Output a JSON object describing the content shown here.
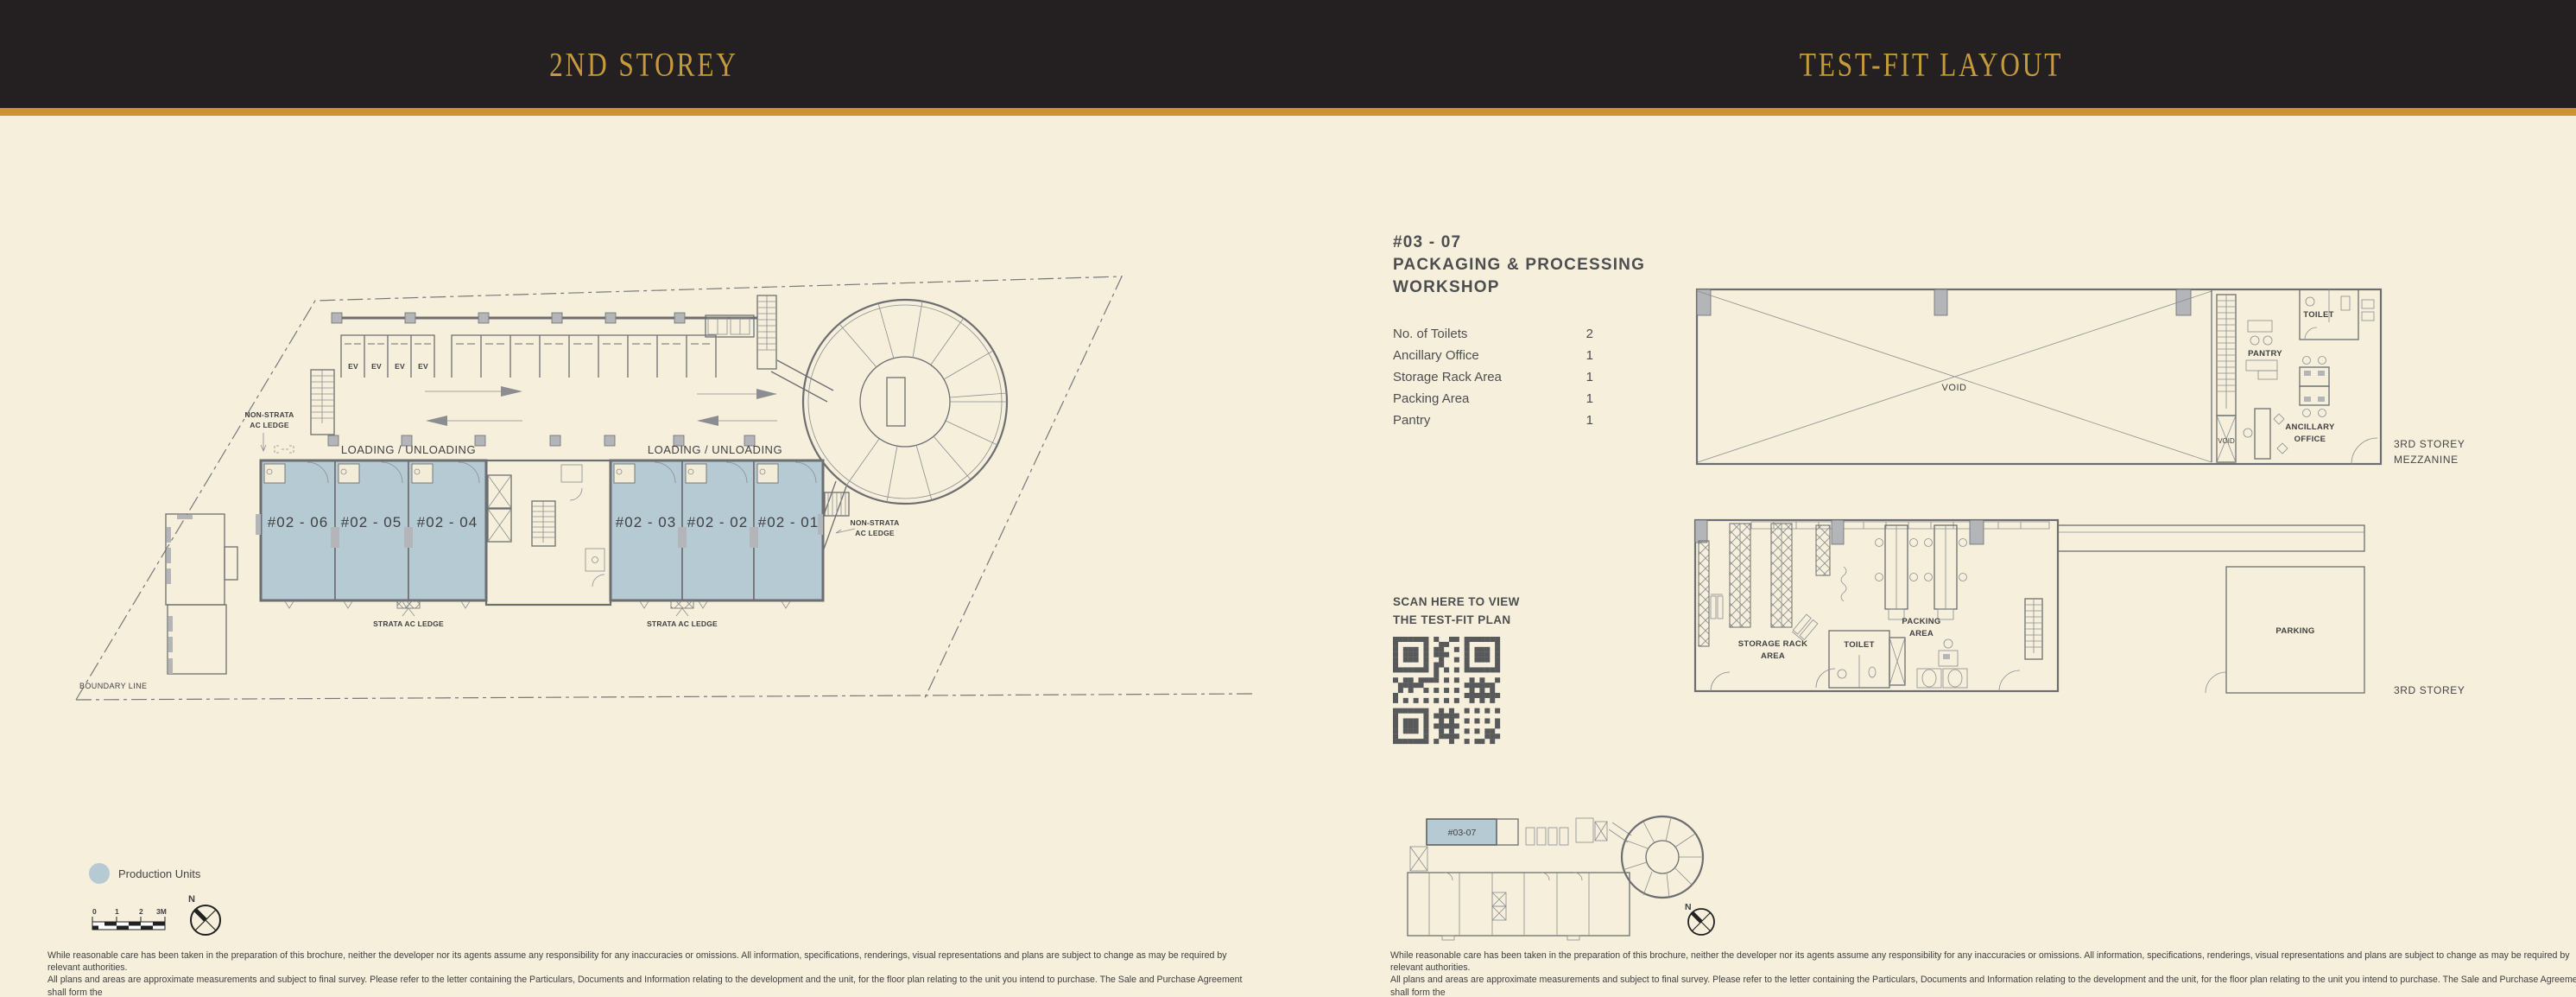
{
  "header": {
    "left_title": "2ND STOREY",
    "right_title": "TEST-FIT LAYOUT"
  },
  "left_plan": {
    "units": [
      "#02 - 06",
      "#02 - 05",
      "#02 - 04",
      "#02 - 03",
      "#02 - 02",
      "#02 - 01"
    ],
    "labels": {
      "loading_left": "LOADING / UNLOADING",
      "loading_right": "LOADING / UNLOADING",
      "strata_left": "STRATA AC LEDGE",
      "strata_right": "STRATA AC LEDGE",
      "non_strata_left_1": "NON-STRATA",
      "non_strata_left_2": "AC LEDGE",
      "non_strata_right_1": "NON-STRATA",
      "non_strata_right_2": "AC LEDGE",
      "boundary": "BOUNDARY LINE",
      "ev": "EV"
    },
    "legend": {
      "label": "Production Units",
      "swatch_color": "#b5cad3"
    },
    "scale_ticks": [
      "0",
      "1",
      "2",
      "3M"
    ],
    "compass_n": "N"
  },
  "right_panel": {
    "unit_no": "#03 - 07",
    "unit_title_1": "PACKAGING & PROCESSING",
    "unit_title_2": "WORKSHOP",
    "facilities": [
      {
        "label": "No. of Toilets",
        "value": "2"
      },
      {
        "label": "Ancillary Office",
        "value": "1"
      },
      {
        "label": "Storage Rack Area",
        "value": "1"
      },
      {
        "label": "Packing Area",
        "value": "1"
      },
      {
        "label": "Pantry",
        "value": "1"
      }
    ],
    "qr_caption_1": "SCAN HERE TO VIEW",
    "qr_caption_2": "THE TEST-FIT PLAN",
    "mezzanine": {
      "void_big": "VOID",
      "void_small": "VOID",
      "pantry": "PANTRY",
      "toilet": "TOILET",
      "ancillary_1": "ANCILLARY",
      "ancillary_2": "OFFICE",
      "side_1": "3RD STOREY",
      "side_2": "MEZZANINE"
    },
    "storey": {
      "storage_1": "STORAGE RACK",
      "storage_2": "AREA",
      "toilet": "TOILET",
      "packing_1": "PACKING",
      "packing_2": "AREA",
      "parking": "PARKING",
      "side": "3RD STOREY"
    },
    "key_plan": {
      "unit": "#03-07",
      "compass_n": "N"
    }
  },
  "disclaimer": {
    "line1": "While reasonable care has been taken in the preparation of this brochure, neither the developer nor its agents assume any responsibility for any inaccuracies or omissions. All information, specifications, renderings, visual representations and plans are subject to change as may be required by relevant authorities.",
    "line2": "All plans and areas are approximate measurements and subject to final survey. Please refer to the letter containing the Particulars, Documents and Information relating to the development and the unit, for the floor plan relating to the unit you intend to purchase. The Sale and Purchase Agreement shall form the",
    "line3": "entire agreement between the developer and the purchaser and supersedes in all respects all previous representations, warranties, promises, inducements or statements of intention, whether written or oral made by the developer and/or the developer's agent which are not in the Sale and Purchase Agreement."
  }
}
